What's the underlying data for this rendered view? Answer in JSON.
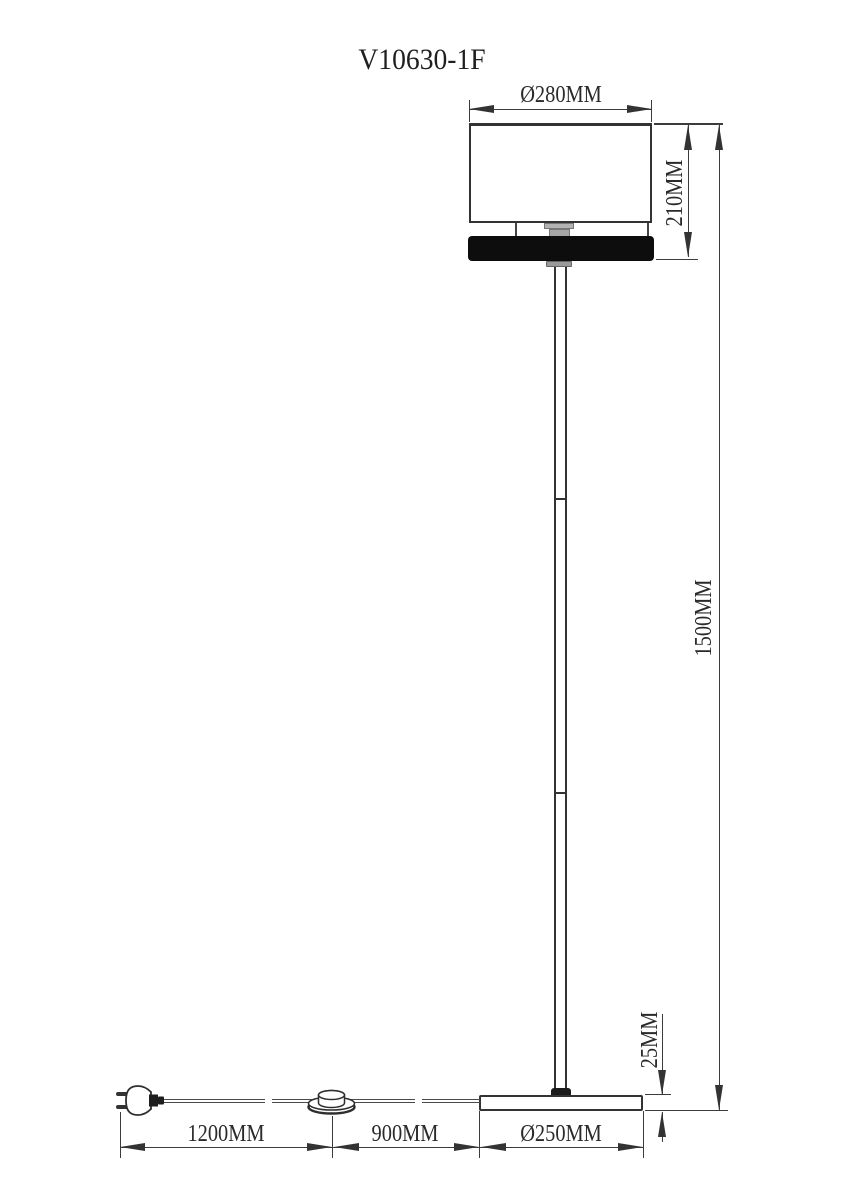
{
  "title": "V10630-1F",
  "dimensions": {
    "shade_diameter": "Ø280MM",
    "shade_height": "210MM",
    "total_height": "1500MM",
    "base_thickness": "25MM",
    "base_diameter": "Ø250MM",
    "cord_plug_to_switch": "1200MM",
    "cord_switch_to_base": "900MM"
  },
  "colors": {
    "line": "#3c3c3c",
    "shade_outline": "#333333",
    "diffuser_fill": "#0d0d0d",
    "socket_gray": "#a6a6a6",
    "background": "#ffffff"
  }
}
